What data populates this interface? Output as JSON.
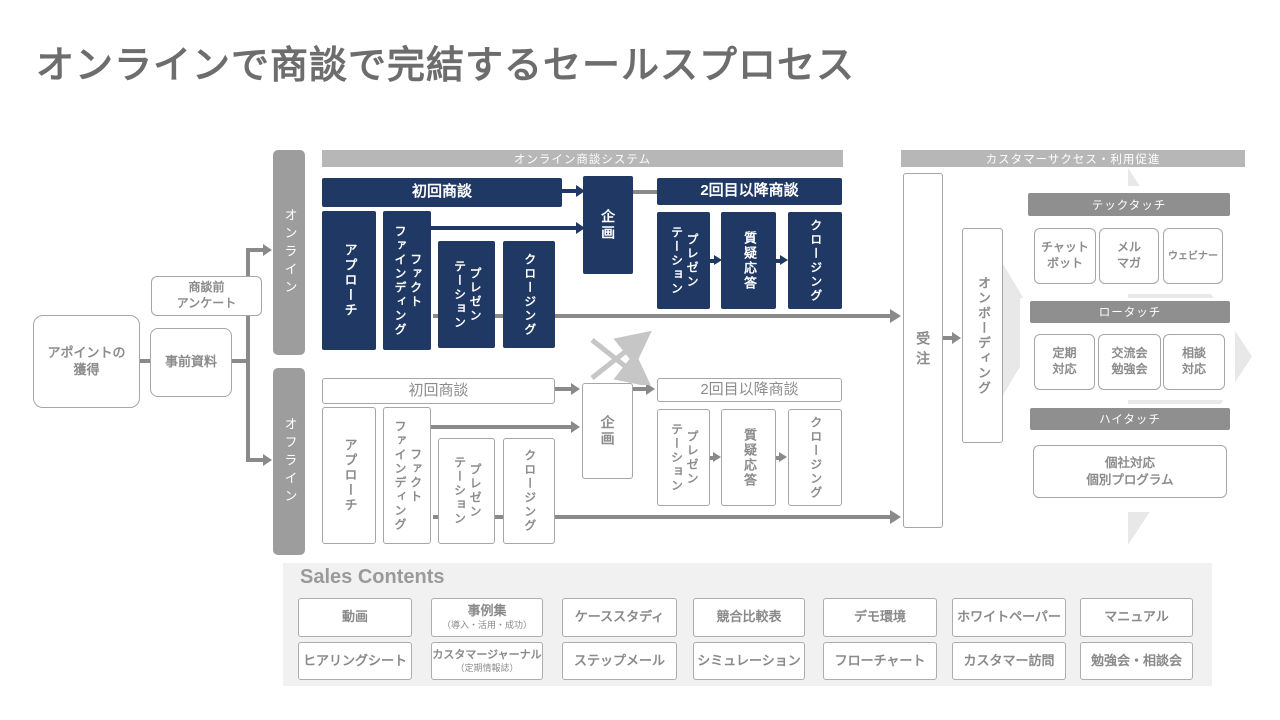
{
  "title": "オンラインで商談で完結するセールスプロセス",
  "colors": {
    "navy": "#1f3864",
    "bar_light_gray": "#b7b7b7",
    "bar_dark_gray": "#8f8f8f",
    "lane_gray": "#9d9d9d",
    "border_gray": "#a6a6a6",
    "text_gray": "#8c8c8c",
    "arrow_gray": "#8a8a8a",
    "light_arrow": "#c6c6c6",
    "chevron_bg": "#e8e8e8",
    "sales_panel_bg": "#f1f1f1"
  },
  "left": {
    "appoint": "アポイントの\n獲得",
    "predocs": "事前資料",
    "survey": "商談前\nアンケート"
  },
  "lanes": {
    "online": "オンライン",
    "offline": "オフライン"
  },
  "online": {
    "system_bar": "オンライン商談システム",
    "first_meeting": "初回商談",
    "steps1": [
      "アプローチ",
      "ファクト\nファインディング",
      "プレゼン\nテーション",
      "クロージング"
    ],
    "planning": "企画",
    "second_meeting": "2回目以降商談",
    "steps2": [
      "プレゼン\nテーション",
      "質疑応答",
      "クロージング"
    ]
  },
  "offline": {
    "first_meeting": "初回商談",
    "steps1": [
      "アプローチ",
      "ファクト\nファインディング",
      "プレゼン\nテーション",
      "クロージング"
    ],
    "planning": "企画",
    "second_meeting": "2回目以降商談",
    "steps2": [
      "プレゼン\nテーション",
      "質疑応答",
      "クロージング"
    ]
  },
  "order_label": "受注",
  "onboarding": "オンボーディング",
  "cs": {
    "bar": "カスタマーサクセス・利用促進",
    "tech": {
      "label": "テックタッチ",
      "items": [
        "チャット\nボット",
        "メル\nマガ",
        "ウェビナー"
      ]
    },
    "low": {
      "label": "ロータッチ",
      "items": [
        "定期\n対応",
        "交流会\n勉強会",
        "相談\n対応"
      ]
    },
    "high": {
      "label": "ハイタッチ",
      "item": "個社対応\n個別プログラム"
    }
  },
  "sales": {
    "title": "Sales Contents",
    "row1": [
      {
        "label": "動画"
      },
      {
        "label": "事例集",
        "sub": "（導入・活用・成功）"
      },
      {
        "label": "ケーススタディ"
      },
      {
        "label": "競合比較表"
      },
      {
        "label": "デモ環境"
      },
      {
        "label": "ホワイトペーパー"
      },
      {
        "label": "マニュアル"
      }
    ],
    "row2": [
      {
        "label": "ヒアリングシート"
      },
      {
        "label": "カスタマージャーナル",
        "sub": "（定期情報誌）"
      },
      {
        "label": "ステップメール"
      },
      {
        "label": "シミュレーション"
      },
      {
        "label": "フローチャート"
      },
      {
        "label": "カスタマー訪問"
      },
      {
        "label": "勉強会・相談会"
      }
    ]
  }
}
